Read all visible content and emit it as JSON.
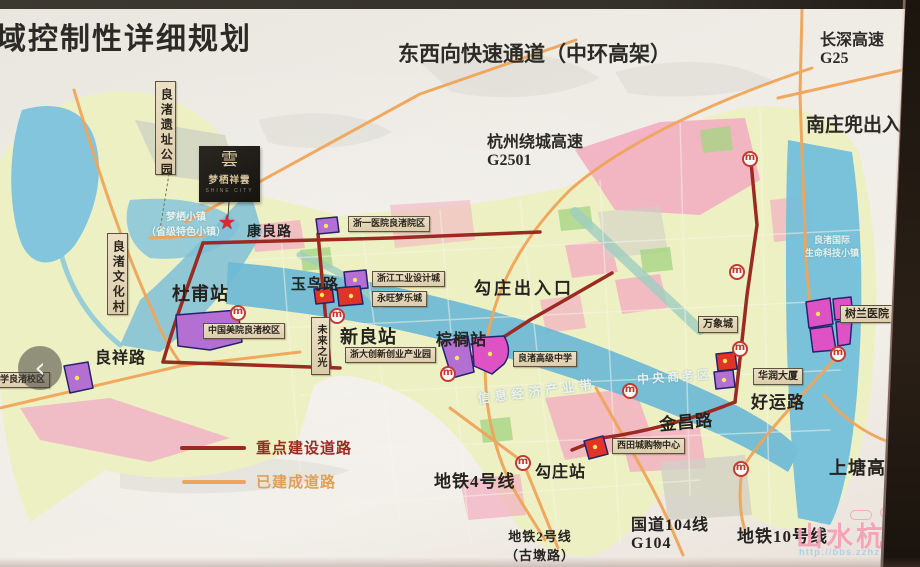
{
  "titles": {
    "plan": "域控制性详细规划",
    "expressway": "东西向快速通道（中环高架）",
    "changshen1": "长深高速",
    "changshen2": "G25",
    "nanzhuangdou": "南庄兜出入口",
    "raocheng1": "杭州绕城高速",
    "raocheng2": "G2501"
  },
  "landmarks": {
    "liangzhu_park": "良渚遗址公园",
    "liangzhu_village": "良渚文化村",
    "future_light": "未来之光",
    "zheyi_hospital": "浙一医院良渚院区",
    "design_town": "浙江工业设计城",
    "aeon_mall": "永旺梦乐城",
    "caa_campus": "中国美院良渚校区",
    "primary_school": "小学良渚校区",
    "zju_park": "浙大创新创业产业园",
    "highschool": "良渚高级中学",
    "mixc": "万象城",
    "crland_tower": "华润大厦",
    "xitiancheng": "西田城购物中心",
    "shulan_hospital": "树兰医院"
  },
  "stations": {
    "dufu": "杜甫站",
    "xinliang": "新良站",
    "palm": "棕榈站",
    "gouzhuang": "勾庄站"
  },
  "roads": {
    "kangliang": "康良路",
    "yuniao": "玉鸟路",
    "liangxiang": "良祥路",
    "haoyun": "好运路",
    "jinchang": "金昌路",
    "shangtang": "上塘高架",
    "metro4": "地铁4号线",
    "metro10": "地铁10号线",
    "metro2a": "地铁2号线",
    "metro2b": "（古墩路）",
    "g104a": "国道104线",
    "g104b": "G104",
    "gouzhuang_exit": "勾庄出入口"
  },
  "zones": {
    "mengqi1": "梦栖小镇",
    "mengqi2": "（省级特色小镇）",
    "info_belt": "信息经济产业带",
    "cbd": "中央商务区",
    "lz_intl1": "良渚国际",
    "lz_intl2": "生命科技小镇"
  },
  "legend": {
    "key_roads": "重点建设道路",
    "built_roads": "已建成道路"
  },
  "logo": {
    "mark": "雲",
    "name": "梦栖祥雲",
    "subtitle": "SHINE CITY"
  },
  "watermark": {
    "brand": "山水杭州",
    "url": "http://bbs.zzhz.com.cn",
    "badge": "BBS"
  },
  "viewer": {
    "prev": "‹"
  },
  "icons": {
    "metro": "m",
    "star": "★"
  },
  "colors": {
    "key_road": "#9b2b22",
    "built_road": "#eda55e",
    "metro_red": "#c23b30",
    "water_blue": "#74bfda",
    "parcel_purple": "#b36fd2",
    "parcel_magenta": "#df52c5",
    "parcel_red": "#e03428",
    "paper": "#efece6"
  }
}
